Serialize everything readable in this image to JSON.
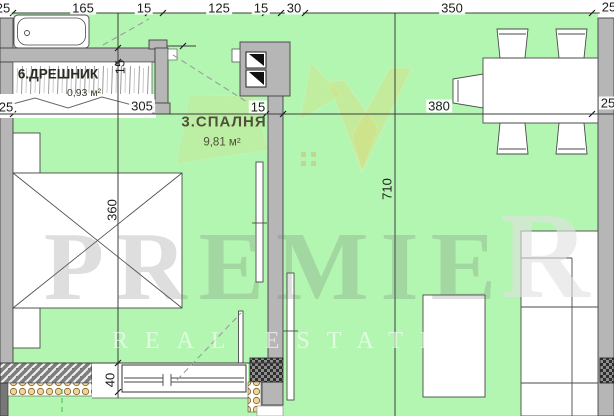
{
  "plan_title": "apartment floor plan",
  "rooms": [
    {
      "label": "6.ДРЕШНИК",
      "area": "0,93 м²"
    },
    {
      "label": "3.СПАЛНЯ",
      "area": "9,81 м²"
    }
  ],
  "dimensions": {
    "top": [
      "25",
      "165",
      "15",
      "125",
      "15",
      "30",
      "350",
      "25"
    ],
    "middle": [
      "25",
      "305",
      "15",
      "380",
      "25"
    ],
    "vertical": [
      "15",
      "360",
      "710",
      "40"
    ]
  },
  "watermark": {
    "brand_part1": "PREMIE",
    "brand_part2": "R",
    "tagline": "REAL ESTATE"
  },
  "colors": {
    "floor_green": "#b3f6b1",
    "wall_gray": "#b6b6b6",
    "wing_yellow": "#e8d56a",
    "insulation_tan": "#f2d49b"
  }
}
